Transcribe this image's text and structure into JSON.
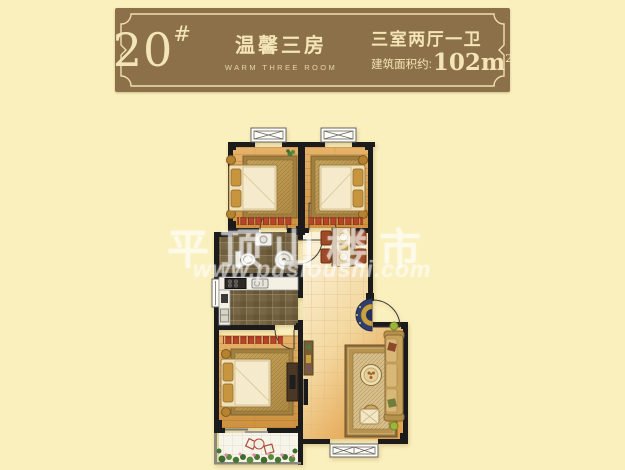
{
  "page": {
    "background_color": "#FAF0BE"
  },
  "plaque": {
    "unit_number": "20",
    "unit_hash": "#",
    "name_cn": "温馨三房",
    "name_en": "WARM THREE ROOM",
    "layout_spec": "三室两厅一卫",
    "area_label": "建筑面积约:",
    "area_value": "102m",
    "area_sup": "2",
    "bg_color": "#8C7049",
    "text_color": "#F3E5B6",
    "border_color": "#EFDFAC"
  },
  "watermark": {
    "title": "平顶山楼市",
    "url": "www.pdsloushi.com"
  },
  "floorplan": {
    "colors": {
      "wall": "#1B1B1B",
      "wood_floor_light": "#E6B269",
      "wood_floor_dark": "#CE9240",
      "hall_tile_light": "#FCF5DF",
      "hall_tile_dark": "#E4A04A",
      "mosaic_tile": "#6F5E3D",
      "radiator_red": "#B5452A",
      "rug_brown": "#B08B45",
      "bed_cream": "#F5EBCC",
      "pillow_gold": "#C8953F",
      "sofa_gold": "#C9A35B",
      "entry_mat_navy": "#2E3F6E",
      "entry_mat_gold": "#C9A23F",
      "plant_green": "#4C7C3F",
      "flower_pink": "#E585A8",
      "balcony_tile": "#F7F5EA"
    },
    "depicted_elements": [
      "bedroom-bed-top-left",
      "bedroom-bed-top-right",
      "bedroom-bed-bottom-left",
      "bathroom-toilet",
      "bathroom-sink",
      "bathroom-shower",
      "kitchen-stove",
      "kitchen-sink",
      "kitchen-counter",
      "dining-table-with-four-chairs",
      "living-room-sofa",
      "coffee-table",
      "tv-board",
      "entry-door-with-round-mat",
      "balcony-plants-and-chairs",
      "radiators",
      "window-symbols"
    ]
  }
}
